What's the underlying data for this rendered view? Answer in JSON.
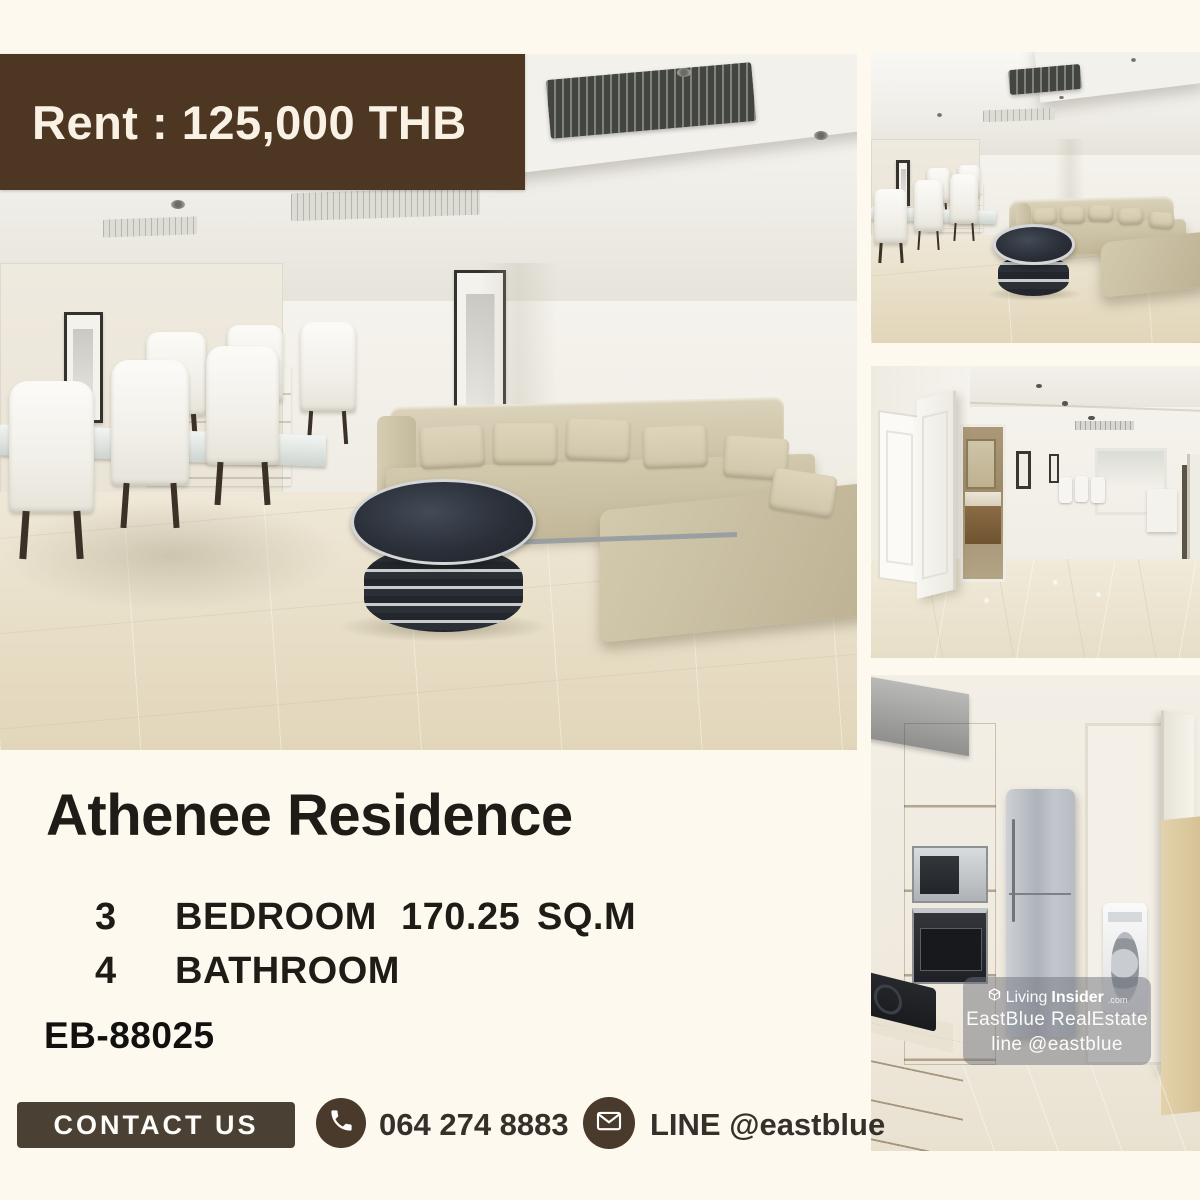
{
  "colors": {
    "bg": "#fdf9ef",
    "brown": "#4e3722",
    "brown_text": "#f8f1e4",
    "contact_bg": "#4a4134",
    "badge_bg": "#493a2b",
    "ink": "#1f1c18",
    "contact_ink": "#35302a",
    "wm_bg": "#70727c80"
  },
  "banner": {
    "label": "Rent : 125,000 THB"
  },
  "listing": {
    "title": "Athenee Residence",
    "bedrooms": {
      "count": "3",
      "label": "BEDROOM"
    },
    "area": {
      "value": "170.25",
      "unit": "SQ.M"
    },
    "bathrooms": {
      "count": "4",
      "label": "BATHROOM"
    },
    "code": "EB-88025"
  },
  "contact": {
    "button_label": "CONTACT US",
    "phone": "064 274 8883",
    "line": "LINE @eastblue"
  },
  "watermark": {
    "brand_prefix": "Living",
    "brand_suffix": "Insider",
    "brand_tld": ".com",
    "line2": "EastBlue RealEstate",
    "line3": "line @eastblue"
  },
  "icons": {
    "phone": "phone-icon",
    "mail": "envelope-icon",
    "logo": "livinginsider-cube-icon"
  }
}
